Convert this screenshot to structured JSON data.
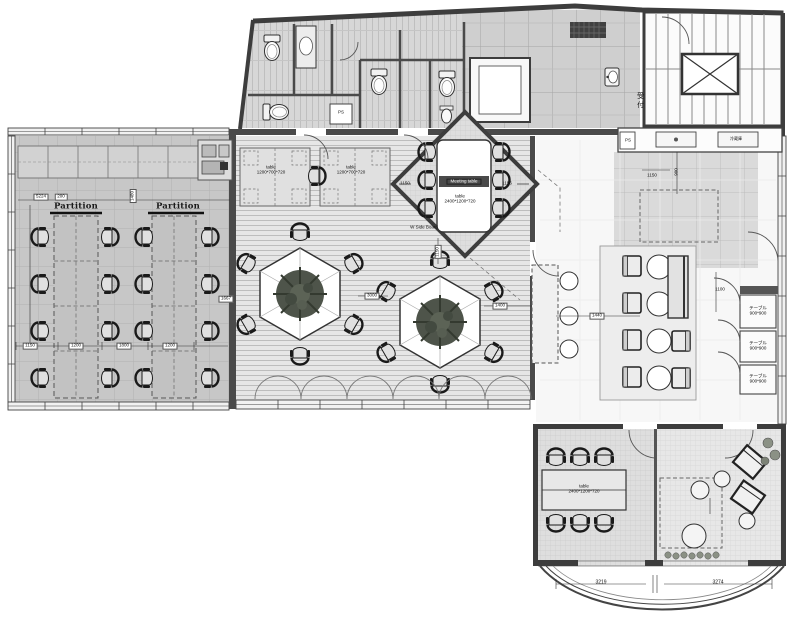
{
  "drawing": {
    "type": "office floor plan"
  },
  "rooms": {
    "reception": "受付",
    "pipe_shaft_1": "PS",
    "pipe_shaft_2": "PS",
    "refrigerator": "冷蔵庫",
    "side_board_note": "W Side Board"
  },
  "furniture": {
    "partition_left": "Partition",
    "partition_right": "Partition",
    "meeting_band": "Meeting table",
    "meeting_l1": "table",
    "meeting_l2": "2400*1200*720",
    "desk1_l1": "table",
    "desk1_l2": "1200*700*720",
    "desk2_l1": "table",
    "desk2_l2": "1200*700*720",
    "small_room_l1": "table",
    "small_room_l2": "2400*1200*720",
    "booths": [
      {
        "l1": "テーブル",
        "l2": "900*900"
      },
      {
        "l1": "テーブル",
        "l2": "900*900"
      },
      {
        "l1": "テーブル",
        "l2": "900*900"
      }
    ]
  },
  "dimensions": {
    "office_top_w": "5224",
    "office_top_s": "200",
    "office_cols": [
      "1150",
      "1200",
      "1800",
      "1200"
    ],
    "office_right": "1667",
    "office_left_v": "1480",
    "center_w": "3000",
    "center_e": "1400",
    "center_n_v": "1150",
    "meeting_w": "1150",
    "meeting_e": "1156",
    "entry_w": "1150",
    "entry_v": "900",
    "lounge_w": "1440",
    "lounge_e": "1100",
    "bay_l": "3219",
    "bay_r": "3274"
  }
}
